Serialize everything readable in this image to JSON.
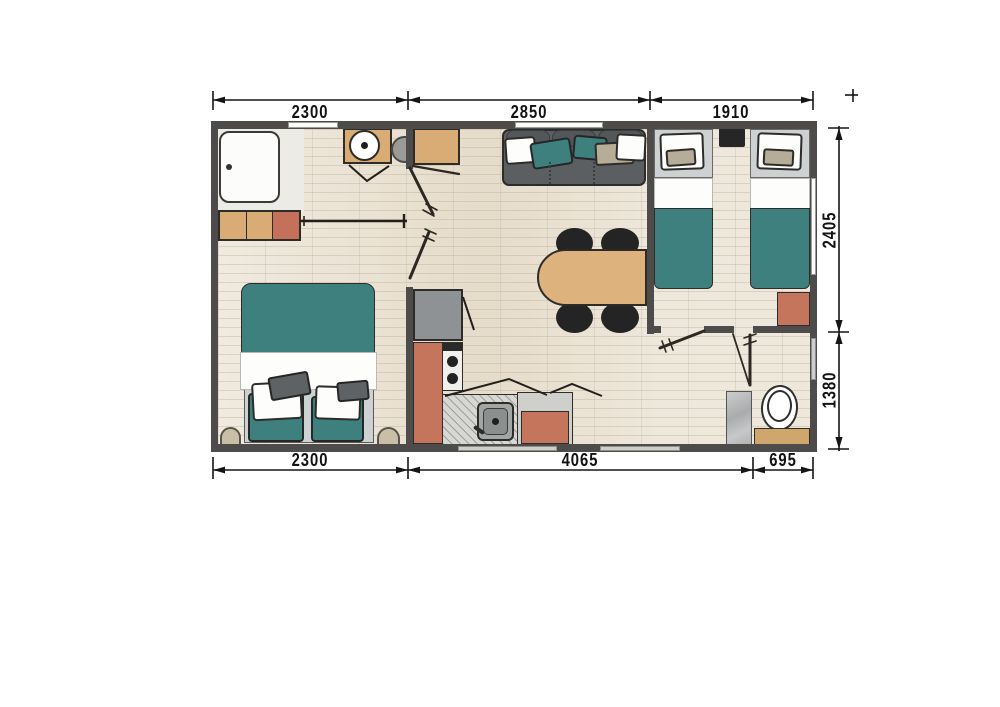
{
  "plan": {
    "type": "floor-plan",
    "dims": {
      "top": [
        "2300",
        "2850",
        "1910"
      ],
      "bottom": [
        "2300",
        "4065",
        "695"
      ],
      "right": [
        "2405",
        "1380"
      ]
    },
    "furniture_icons": [
      "shower-tray-icon",
      "low-cabinet-icon",
      "double-bed-icon",
      "pouf-icon",
      "vanity-basin-icon",
      "stool-icon",
      "wardrobe-icon",
      "sofa-icon",
      "dining-table-icon",
      "chair-icon",
      "fridge-icon",
      "stove-icon",
      "kitchen-sink-icon",
      "counter-icon",
      "tall-cabinet-icon",
      "single-bed-icon",
      "nightstand-icon",
      "toilet-icon",
      "bathroom-cabinet-icon",
      "shower-column-icon",
      "door-swing-icon",
      "sliding-door-icon",
      "window-icon"
    ],
    "colors": {
      "wall": "#4d4c4a",
      "floor": "#e9e1d2",
      "teal": "#3d807e",
      "salmon": "#c4755c",
      "wood": "#d8ac74",
      "sofa_gray": "#5b5f62",
      "headboard_gray": "#cdd1d2",
      "appliance_gray": "#8f9294",
      "counter_gray": "#d6d7d3",
      "beige": "#c8bfa6",
      "chair_black": "#232423",
      "line": "#151515"
    }
  }
}
